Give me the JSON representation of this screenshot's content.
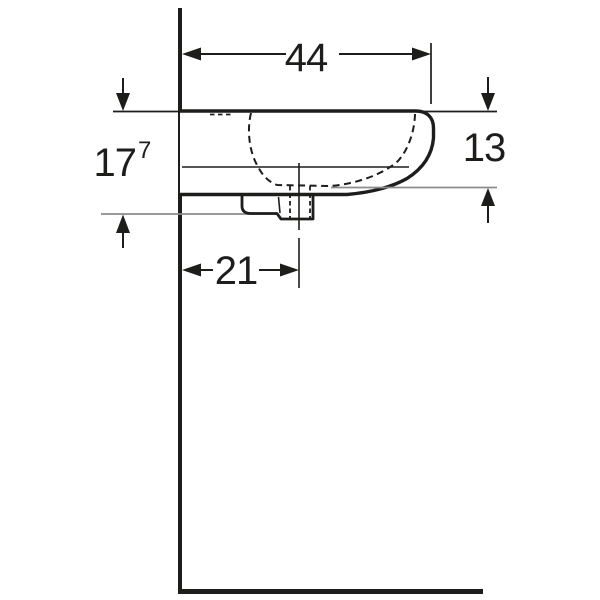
{
  "colors": {
    "ink": "#1d1d1b",
    "gray": "#8c8c8c",
    "background": "#ffffff"
  },
  "dimensions": {
    "overall_width": {
      "value": "44"
    },
    "front_height": {
      "value": "13"
    },
    "wall_height": {
      "value": "17",
      "note_sup": "7"
    },
    "drain_center_distance": {
      "value": "21"
    }
  }
}
